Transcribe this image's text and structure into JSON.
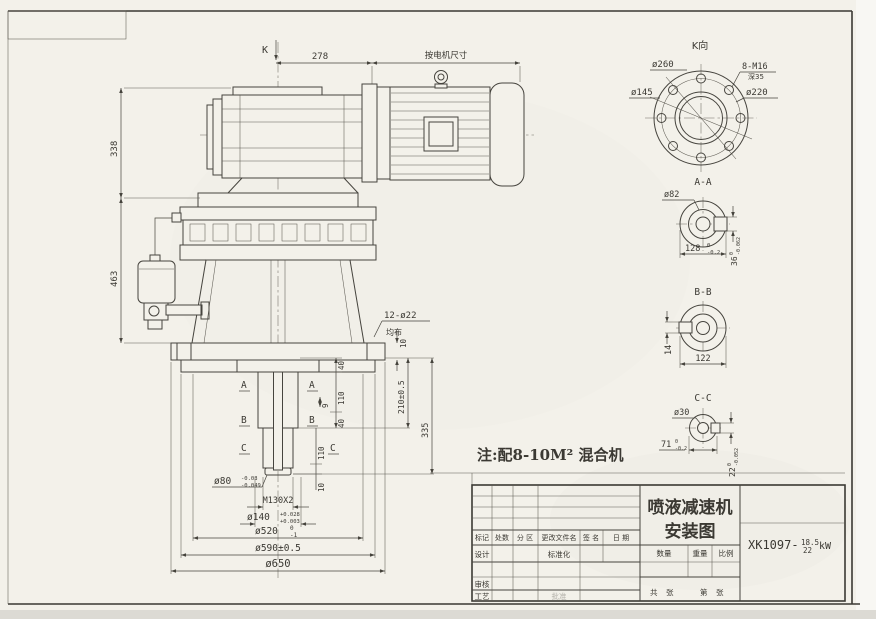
{
  "sheet": {
    "paper_color": "#f3f1ea",
    "line_color": "#46443e"
  },
  "front_view": {
    "k_label": "K",
    "dim_278": "278",
    "motor_dim_note": "按电机尺寸",
    "dim_338": "338",
    "dim_463": "463",
    "holes_spec": "12-ø22",
    "holes_layout": "均布",
    "plate_thk": "10",
    "chain_40a": "40",
    "chain_110a": "110",
    "chain_9": "9",
    "chain_40b": "40",
    "chain_110b": "110",
    "chain_10": "10",
    "dim_210": "210±0.5",
    "dim_335": "335",
    "shaft_dia": "ø80",
    "shaft_dia_tol_hi": "-0.03",
    "shaft_dia_tol_lo": "-0.049",
    "thread_spec": "M130X2",
    "bore_dia": "ø140",
    "bore_tol_hi": "+0.028",
    "bore_tol_lo": "+0.003",
    "dia_520": "ø520",
    "dia_520_tol_hi": "0",
    "dia_520_tol_lo": "-1",
    "dia_590": "ø590±0.5",
    "dia_650": "ø650",
    "sec_a": "A",
    "sec_b": "B",
    "sec_c": "C",
    "note": "注:配8-10M² 混合机"
  },
  "view_k": {
    "title": "K向",
    "dia_outer": "ø260",
    "dia_pilot": "ø145",
    "dia_bolt_circle": "ø220",
    "bolt_spec": "8-M16",
    "bolt_depth": "深35"
  },
  "section_aa": {
    "title": "A-A",
    "dia_bore": "ø82",
    "width": "128",
    "width_tol_hi": "0",
    "width_tol_lo": "-0.2",
    "key": "36",
    "key_tol_hi": "0",
    "key_tol_lo": "-0.062"
  },
  "section_bb": {
    "title": "B-B",
    "key_width": "14",
    "width": "122"
  },
  "section_cc": {
    "title": "C-C",
    "dia_bore": "ø30",
    "width": "71",
    "width_tol_hi": "0",
    "width_tol_lo": "-0.2",
    "key": "22",
    "key_tol_hi": "0",
    "key_tol_lo": "-0.052"
  },
  "title_block": {
    "title_line1": "喷液减速机",
    "title_line2": "安装图",
    "dwg_no_prefix": "XK1097-",
    "dwg_no_numer": "18.5",
    "dwg_no_denom": "22",
    "dwg_no_unit": "kW",
    "col_mark": "标记",
    "col_count": "处数",
    "col_zone": "分 区",
    "col_file": "更改文件名",
    "col_sign": "签 名",
    "col_date": "日 期",
    "row_design": "设计",
    "row_standard": "标准化",
    "row_check": "审核",
    "row_process": "工艺",
    "row_approve": "批准",
    "qty": "数量",
    "weight": "重量",
    "scale": "比例",
    "total": "共",
    "sheet_a": "张",
    "ordinal": "第",
    "sheet_b": "张"
  }
}
